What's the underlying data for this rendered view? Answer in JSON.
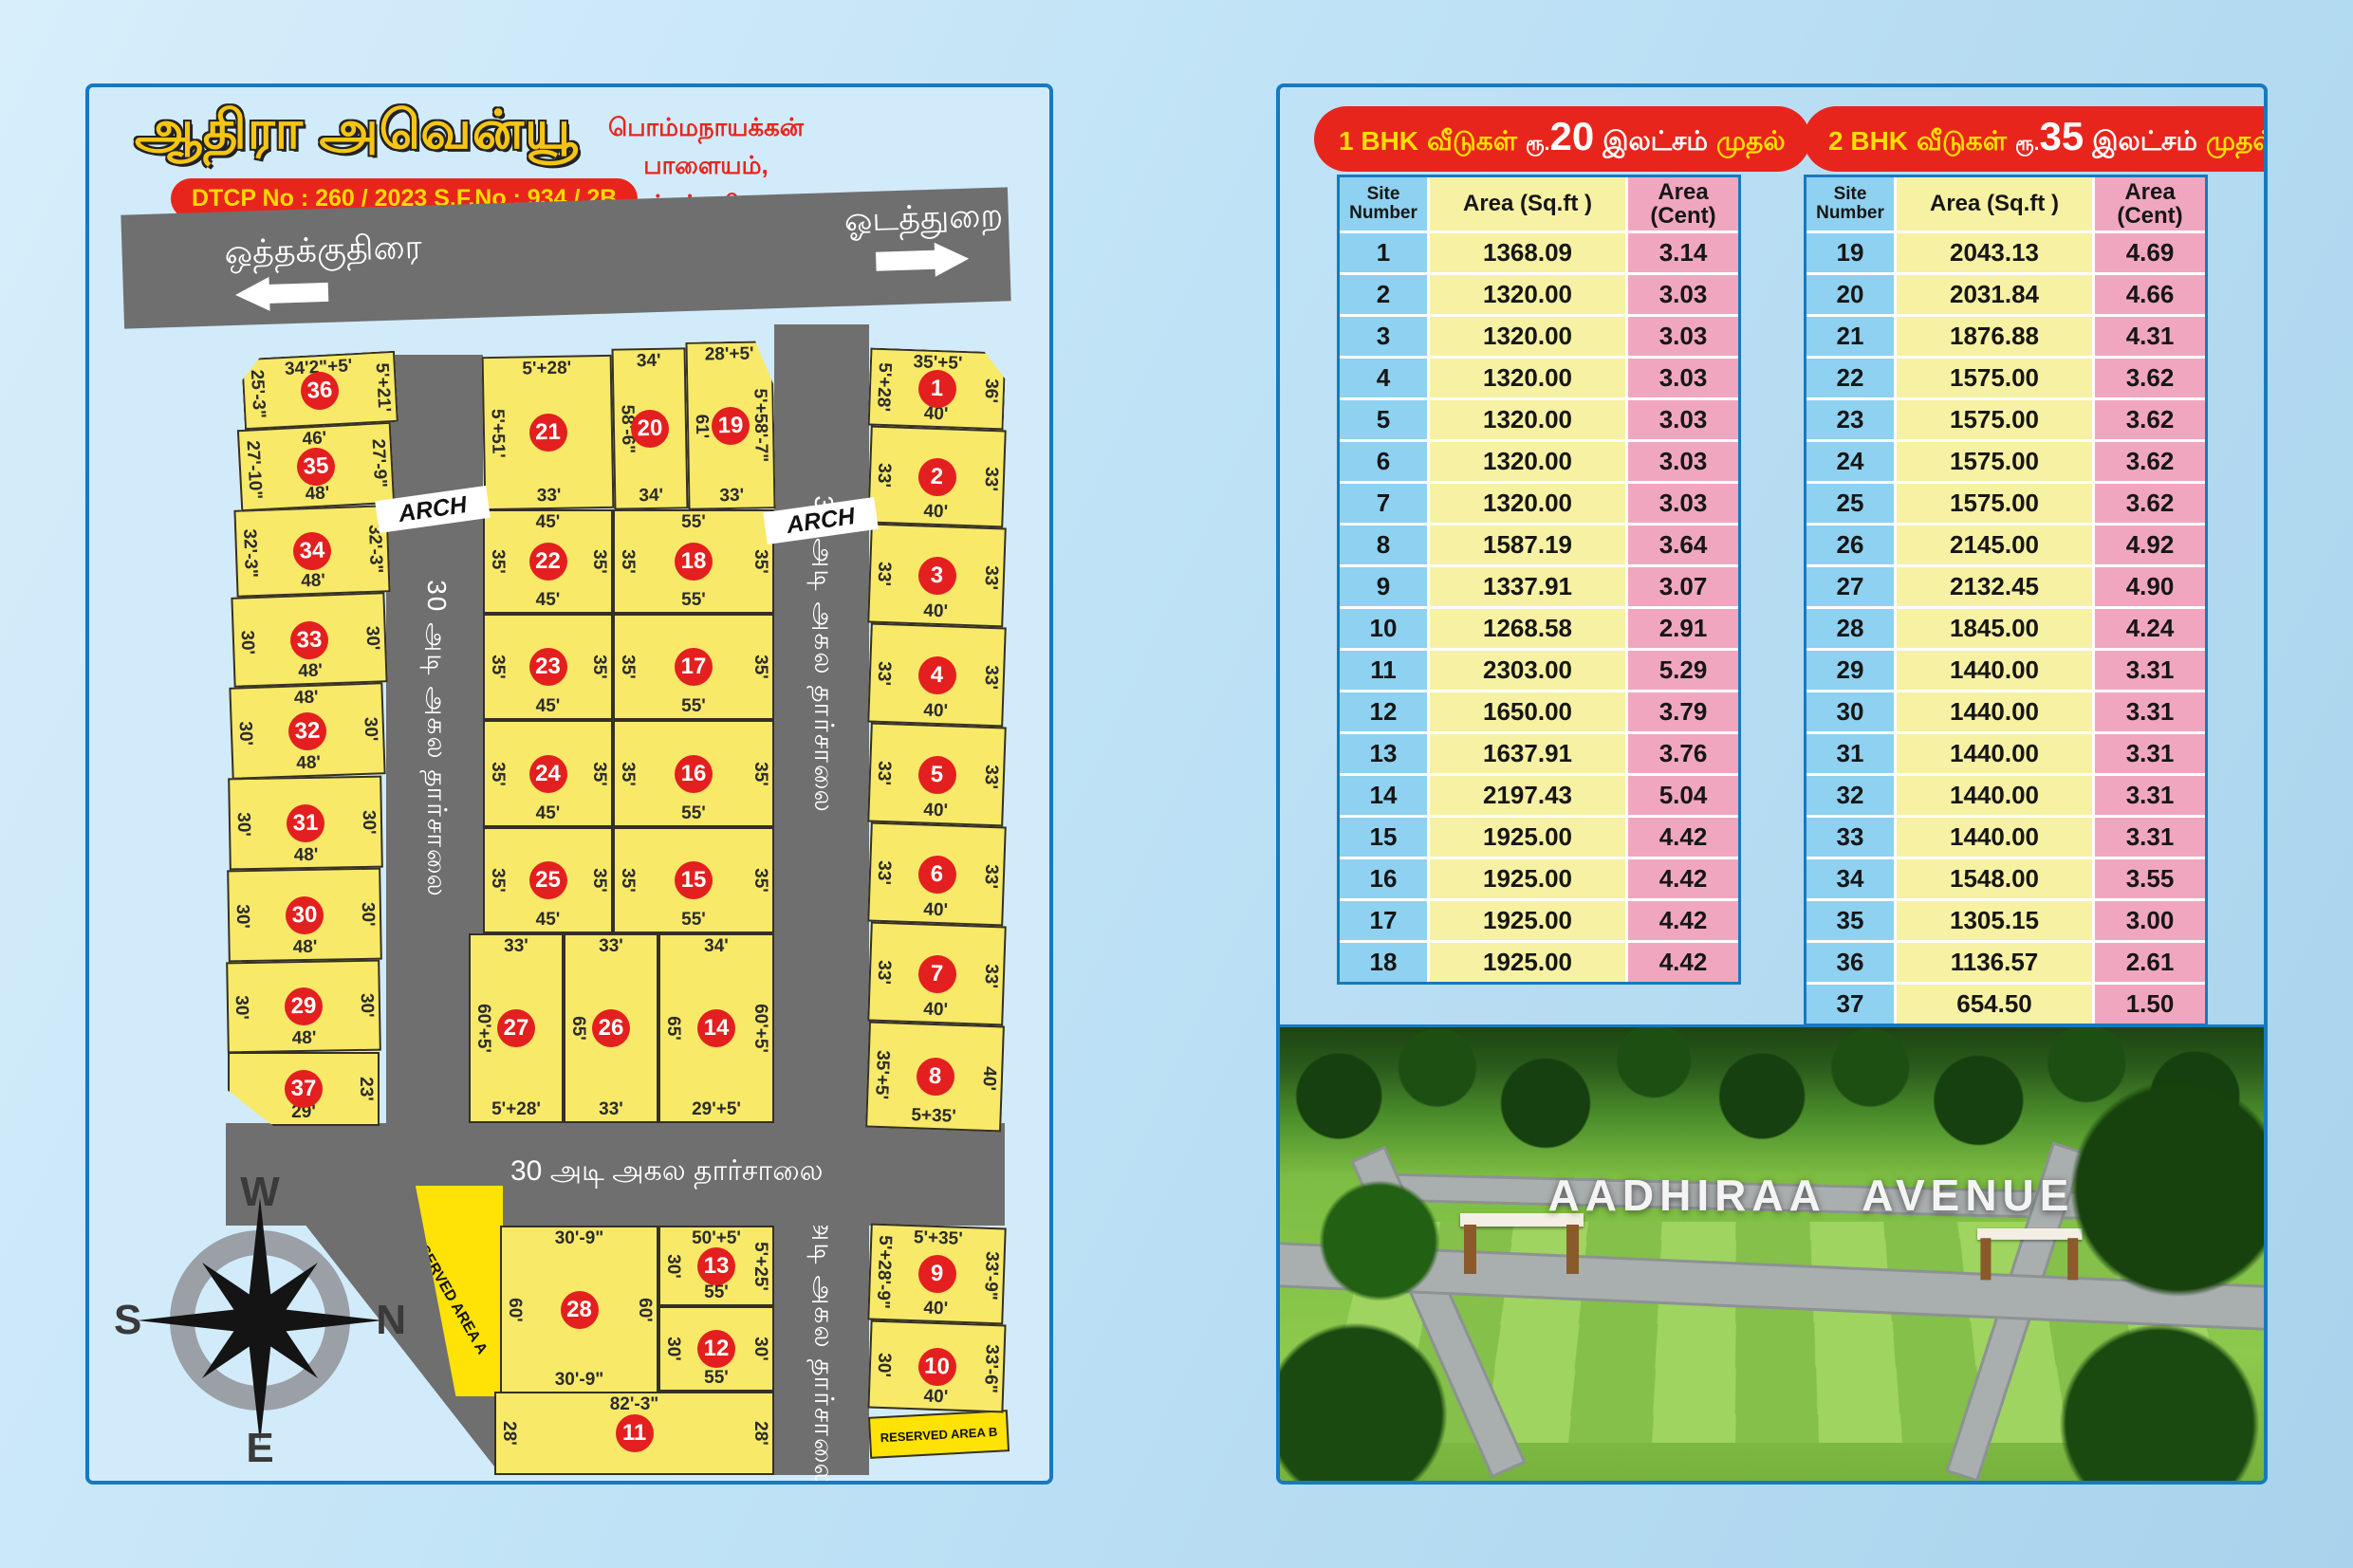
{
  "left_panel": {
    "title": "ஆதிரா அவென்யூ",
    "dtcp_label": "DTCP No : 260 / 2023 S.F.No : 934 / 2B",
    "location": [
      "பொம்மநாயக்கன் பாளையம்,",
      "ஒத்தக்குதிரை."
    ],
    "top_road": {
      "left_name": "ஒத்தக்குதிரை",
      "right_name": "ஓடத்துறை"
    },
    "road_30_vertical": "30 அடி அகல தார்சாலை",
    "road_33_vertical": "33 அடி அகல தார்சாலை",
    "road_30_bottom": "30 அடி அகல தார்சாலை",
    "arch_label": "ARCH",
    "reserved_area_a": "RESERVED AREA A",
    "reserved_area_b": "RESERVED AREA B",
    "compass": {
      "top": "W",
      "right": "N",
      "left": "S",
      "bottom": "E"
    },
    "plots": [
      {
        "n": "1",
        "top": "35'+5'",
        "left": "5'+28'",
        "right": "36'",
        "bottom": "40'"
      },
      {
        "n": "2",
        "left": "33'",
        "right": "33'",
        "bottom": "40'"
      },
      {
        "n": "3",
        "left": "33'",
        "right": "33'",
        "bottom": "40'"
      },
      {
        "n": "4",
        "left": "33'",
        "right": "33'",
        "bottom": "40'"
      },
      {
        "n": "5",
        "left": "33'",
        "right": "33'",
        "bottom": "40'"
      },
      {
        "n": "6",
        "left": "33'",
        "right": "33'",
        "bottom": "40'"
      },
      {
        "n": "7",
        "left": "33'",
        "right": "33'",
        "bottom": "40'"
      },
      {
        "n": "8",
        "left": "35'+5'",
        "right": "40'",
        "bottom": "5+35'"
      },
      {
        "n": "9",
        "top": "5'+35'",
        "left": "5'+28'-9\"",
        "right": "33'-9\"",
        "bottom": "40'"
      },
      {
        "n": "10",
        "left": "30'",
        "right": "33'-6\"",
        "bottom": "40'"
      },
      {
        "n": "11",
        "top": "82'-3\"",
        "left": "28'",
        "right": "28'"
      },
      {
        "n": "12",
        "left": "30'",
        "right": "30'",
        "bottom": "55'"
      },
      {
        "n": "13",
        "top": "50'+5'",
        "left": "30'",
        "right": "5'+25'",
        "bottom": "55'"
      },
      {
        "n": "14",
        "top": "34'",
        "left": "65'",
        "right": "60'+5'",
        "bottom": "29'+5'"
      },
      {
        "n": "15",
        "left": "35'",
        "right": "35'",
        "bottom": "55'"
      },
      {
        "n": "16",
        "left": "35'",
        "right": "35'",
        "bottom": "55'"
      },
      {
        "n": "17",
        "left": "35'",
        "right": "35'",
        "bottom": "55'"
      },
      {
        "n": "18",
        "top": "55'",
        "left": "35'",
        "right": "35'",
        "bottom": "55'"
      },
      {
        "n": "19",
        "top": "28'+5'",
        "left": "61'",
        "right": "5'+58'-7\"",
        "bottom": "33'"
      },
      {
        "n": "20",
        "top": "34'",
        "left": "58'-6\"",
        "bottom": "34'"
      },
      {
        "n": "21",
        "top": "5'+28'",
        "left": "5'+51'",
        "bottom": "33'"
      },
      {
        "n": "22",
        "top": "45'",
        "left": "35'",
        "right": "35'",
        "bottom": "45'"
      },
      {
        "n": "23",
        "left": "35'",
        "right": "35'",
        "bottom": "45'"
      },
      {
        "n": "24",
        "left": "35'",
        "right": "35'",
        "bottom": "45'"
      },
      {
        "n": "25",
        "left": "35'",
        "right": "35'",
        "bottom": "45'"
      },
      {
        "n": "26",
        "top": "33'",
        "left": "65'",
        "bottom": "33'"
      },
      {
        "n": "27",
        "top": "33'",
        "left": "60'+5'",
        "bottom": "5'+28'"
      },
      {
        "n": "28",
        "top": "30'-9\"",
        "left": "60'",
        "right": "60'",
        "bottom": "30'-9\""
      },
      {
        "n": "29",
        "left": "30'",
        "right": "30'",
        "bottom": "48'"
      },
      {
        "n": "30",
        "left": "30'",
        "right": "30'",
        "bottom": "48'"
      },
      {
        "n": "31",
        "left": "30'",
        "right": "30'",
        "bottom": "48'"
      },
      {
        "n": "32",
        "top": "48'",
        "left": "30'",
        "right": "30'",
        "bottom": "48'"
      },
      {
        "n": "33",
        "left": "30'",
        "right": "30'",
        "bottom": "48'"
      },
      {
        "n": "34",
        "left": "32'-3\"",
        "right": "32'-3\"",
        "bottom": "48'"
      },
      {
        "n": "35",
        "top": "46'",
        "left": "27'-10\"",
        "right": "27'-9\"",
        "bottom": "48'"
      },
      {
        "n": "36",
        "top": "34'2\"+5'",
        "left": "25'-3\"",
        "right": "5'+21'"
      },
      {
        "n": "37",
        "right": "23'",
        "bottom": "29'"
      }
    ]
  },
  "price_tables": [
    {
      "pill": {
        "bhk": "1 BHK",
        "houses": "வீடுகள்",
        "rupee": "ரூ.",
        "price": "20",
        "lakh": "இலட்சம்",
        "from": "முதல்"
      },
      "columns": [
        "Site Number",
        "Area (Sq.ft )",
        "Area (Cent)"
      ],
      "rows": [
        [
          "1",
          "1368.09",
          "3.14"
        ],
        [
          "2",
          "1320.00",
          "3.03"
        ],
        [
          "3",
          "1320.00",
          "3.03"
        ],
        [
          "4",
          "1320.00",
          "3.03"
        ],
        [
          "5",
          "1320.00",
          "3.03"
        ],
        [
          "6",
          "1320.00",
          "3.03"
        ],
        [
          "7",
          "1320.00",
          "3.03"
        ],
        [
          "8",
          "1587.19",
          "3.64"
        ],
        [
          "9",
          "1337.91",
          "3.07"
        ],
        [
          "10",
          "1268.58",
          "2.91"
        ],
        [
          "11",
          "2303.00",
          "5.29"
        ],
        [
          "12",
          "1650.00",
          "3.79"
        ],
        [
          "13",
          "1637.91",
          "3.76"
        ],
        [
          "14",
          "2197.43",
          "5.04"
        ],
        [
          "15",
          "1925.00",
          "4.42"
        ],
        [
          "16",
          "1925.00",
          "4.42"
        ],
        [
          "17",
          "1925.00",
          "4.42"
        ],
        [
          "18",
          "1925.00",
          "4.42"
        ]
      ]
    },
    {
      "pill": {
        "bhk": "2 BHK",
        "houses": "வீடுகள்",
        "rupee": "ரூ.",
        "price": "35",
        "lakh": "இலட்சம்",
        "from": "முதல்"
      },
      "columns": [
        "Site Number",
        "Area (Sq.ft )",
        "Area (Cent)"
      ],
      "rows": [
        [
          "19",
          "2043.13",
          "4.69"
        ],
        [
          "20",
          "2031.84",
          "4.66"
        ],
        [
          "21",
          "1876.88",
          "4.31"
        ],
        [
          "22",
          "1575.00",
          "3.62"
        ],
        [
          "23",
          "1575.00",
          "3.62"
        ],
        [
          "24",
          "1575.00",
          "3.62"
        ],
        [
          "25",
          "1575.00",
          "3.62"
        ],
        [
          "26",
          "2145.00",
          "4.92"
        ],
        [
          "27",
          "2132.45",
          "4.90"
        ],
        [
          "28",
          "1845.00",
          "4.24"
        ],
        [
          "29",
          "1440.00",
          "3.31"
        ],
        [
          "30",
          "1440.00",
          "3.31"
        ],
        [
          "31",
          "1440.00",
          "3.31"
        ],
        [
          "32",
          "1440.00",
          "3.31"
        ],
        [
          "33",
          "1440.00",
          "3.31"
        ],
        [
          "34",
          "1548.00",
          "3.55"
        ],
        [
          "35",
          "1305.15",
          "3.00"
        ],
        [
          "36",
          "1136.57",
          "2.61"
        ],
        [
          "37",
          "654.50",
          "1.50"
        ]
      ]
    }
  ],
  "photo": {
    "caption": "AADHIRAA AVENUE"
  },
  "colors": {
    "accent_red": "#e8251c",
    "title_yellow": "#f6c513",
    "plot_yellow": "#f8e969",
    "road_gray": "#6f6f6f",
    "panel_border": "#1779bf",
    "col_site_blue": "#8ed1f0",
    "col_sqft_yellow": "#f7f1a3",
    "col_cent_pink": "#f1a6c0"
  }
}
